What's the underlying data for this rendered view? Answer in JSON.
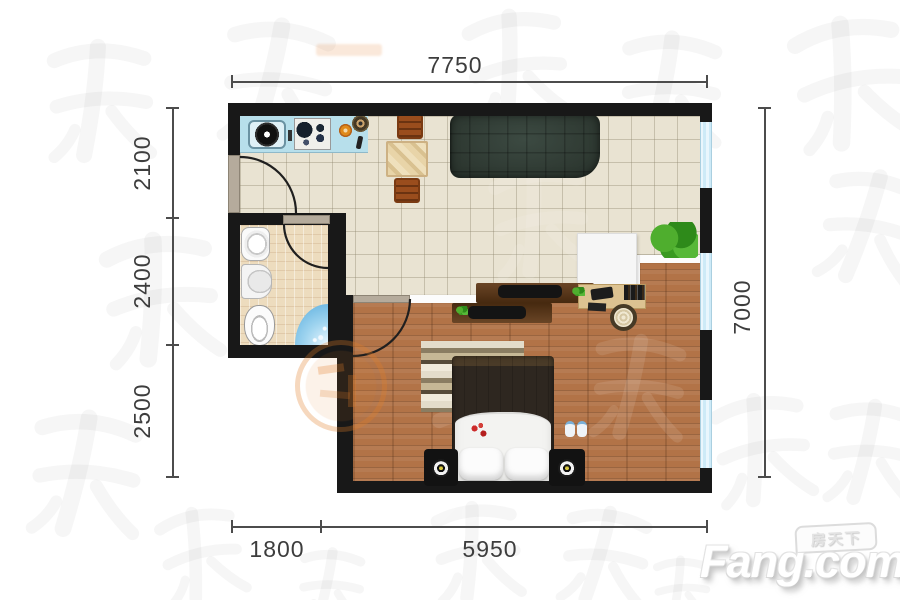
{
  "plan": {
    "type": "apartment-floor-plan",
    "dimensions_mm": {
      "top": "7750",
      "left": [
        "2100",
        "2400",
        "2500"
      ],
      "right": "7000",
      "bottom": [
        "1800",
        "5950"
      ]
    }
  },
  "logo": {
    "brand": "Fang.com",
    "brand_cn": "房天下"
  },
  "colors": {
    "wall": "#181818",
    "tile_floor": "#e9e3d2",
    "bathroom_floor": "#eddcbe",
    "wood_floor": "#b27347",
    "kitchen_counter": "#b7dfeb",
    "window": "#cdeaf7",
    "sofa": "#333e38",
    "shower": "#56abdd",
    "seal_accent": "#e17d28"
  }
}
